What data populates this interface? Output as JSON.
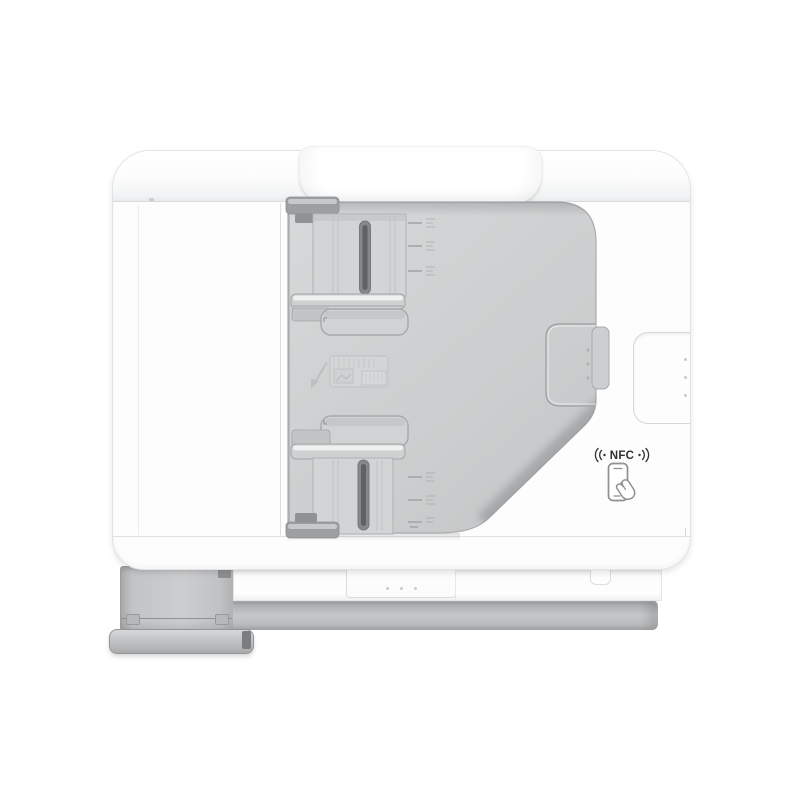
{
  "scene": {
    "type": "product-photo",
    "subject": "white multifunction printer, top view with automatic document feeder",
    "background_color": "#ffffff"
  },
  "printer": {
    "nfc_badge": {
      "label": "NFC",
      "waves_icon": "nfc-signal-waves-icon",
      "phone_icon": "phone-tap-icon",
      "text_color": "#2e3032"
    },
    "colors": {
      "body": "#fdfdfe",
      "adf_tray": "#ced0d1",
      "guide_rail_dark": "#9da0a2",
      "guide_slot": "#5f6164",
      "front_band": "#b7b9bb",
      "output_panel": "#c6c7c9",
      "foot": "#b9babc",
      "edge_outline": "#a9abad"
    },
    "adf": {
      "paper_width_guides": 2,
      "size_tick_rows_top": 3,
      "size_tick_rows_bottom": 3,
      "embossed_marks": [
        "load-paper-icon",
        "load-direction-arrow"
      ]
    },
    "grips": {
      "tray_grip_dots": 3,
      "body_grip_dots": 3,
      "front_panel_dots": 3
    }
  }
}
